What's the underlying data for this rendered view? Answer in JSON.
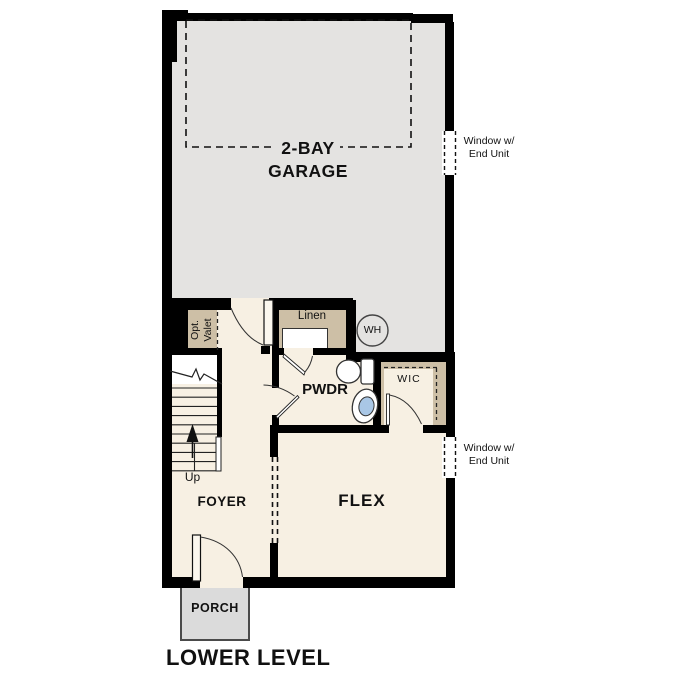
{
  "title": "LOWER LEVEL",
  "labels": {
    "garage_line1": "2-BAY",
    "garage_line2": "GARAGE",
    "linen": "Linen",
    "water_heater": "WH",
    "opt_valet_line1": "Opt.",
    "opt_valet_line2": "Valet",
    "pwdr": "PWDR",
    "wic": "WIC",
    "up": "Up",
    "foyer": "FOYER",
    "flex": "FLEX",
    "porch": "PORCH"
  },
  "annotations": {
    "window_upper": {
      "line1": "Window w/",
      "line2": "End Unit"
    },
    "window_lower": {
      "line1": "Window w/",
      "line2": "End Unit"
    }
  },
  "colors": {
    "wall": "#000000",
    "garage_floor": "#e4e3e1",
    "interior_floor": "#f7f0e3",
    "closet_tan": "#cdbfa6",
    "porch_gray": "#dbdbdb",
    "sink_blue": "#a9c7e6"
  }
}
